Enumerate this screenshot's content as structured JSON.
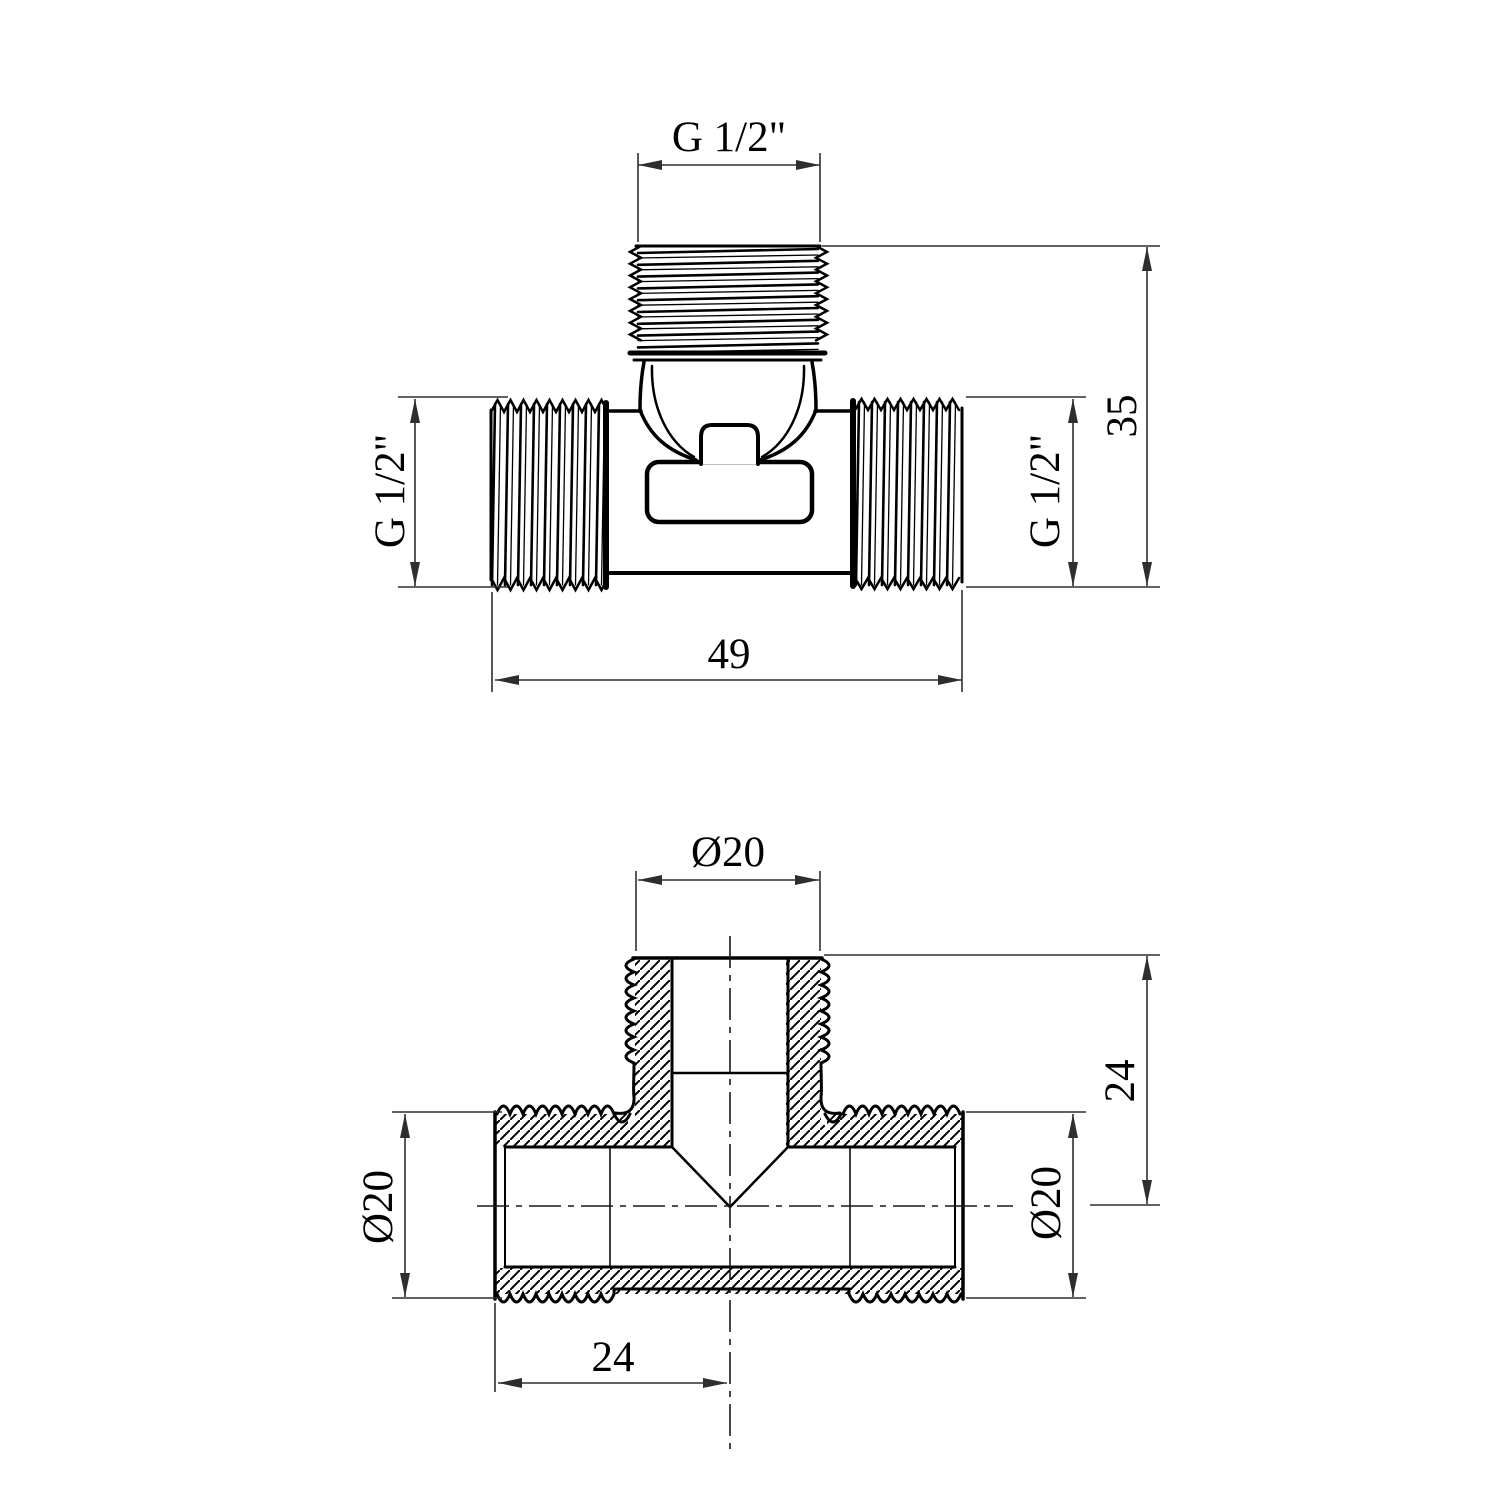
{
  "title": "Tee fitting technical drawing",
  "colors": {
    "background": "#ffffff",
    "outline": "#000000",
    "dimension": "#2e2e2e",
    "centerline": "#1a1a1a"
  },
  "front_view": {
    "name": "front view",
    "dims": {
      "top_thread": "G 1/2\"",
      "left_thread": "G 1/2\"",
      "right_thread": "G 1/2\"",
      "overall_height": "35",
      "overall_width": "49"
    }
  },
  "section_view": {
    "name": "section view",
    "dims": {
      "branch_od": "Ø20",
      "left_od": "Ø20",
      "right_od": "Ø20",
      "branch_height": "24",
      "left_to_center": "24"
    }
  }
}
